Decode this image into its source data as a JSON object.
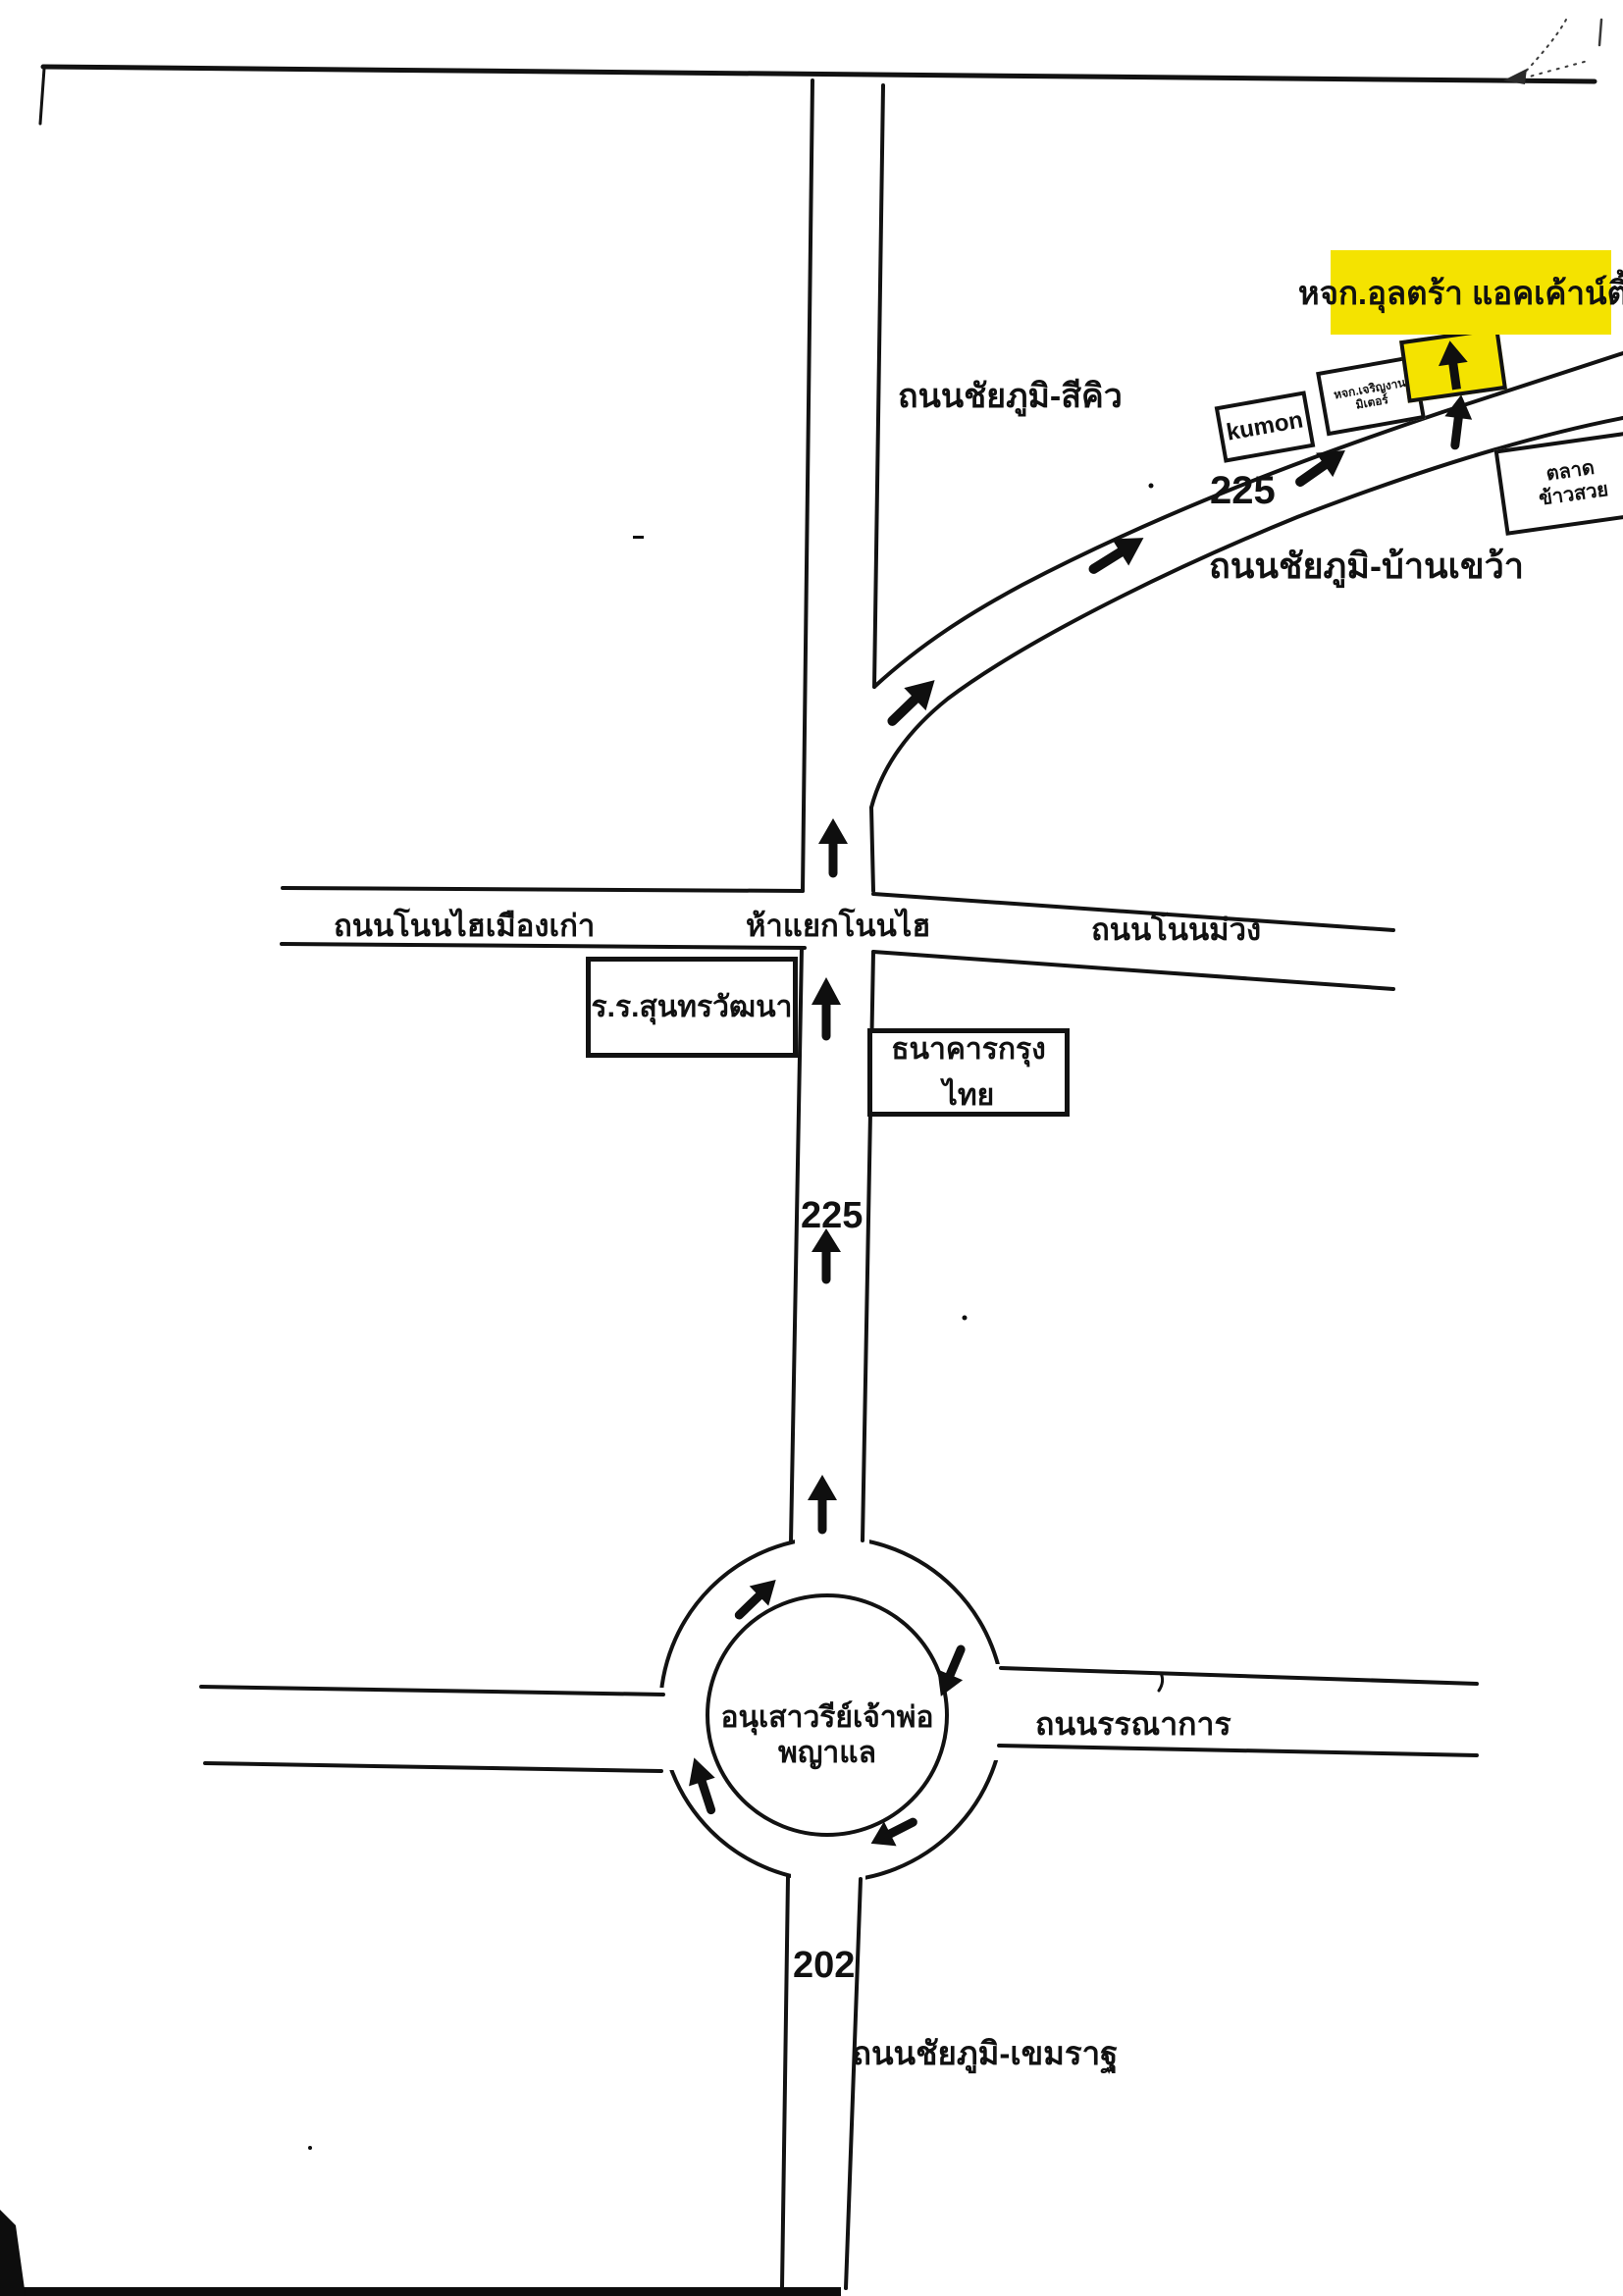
{
  "page": {
    "ink_color": "#111111",
    "highlight_color": "#f4e300",
    "background": "#ffffff"
  },
  "labels": {
    "company_highlight": "หจก.อุลตร้า แอคเค้าน์ติ้ง",
    "road_chaiyaphum_sikhio": "ถนนชัยภูมิ-สีคิว",
    "road_chaiyaphum_bankhwao": "ถนนชัยภูมิ-บ้านเขว้า",
    "road_nonhai_muangkao": "ถนนโนนไฮเมืองเก่า",
    "junction_hayaek_nonhai": "ห้าแยกโนนไฮ",
    "road_nonmuang": "ถนนโนนม่วง",
    "road_bannakan": "ถนนรรณาการ",
    "road_chaiyaphum_khemarat": "ถนนชัยภูมิ-เขมราฐ",
    "route_225_curve": "225",
    "route_225_mid": "225",
    "route_202": "202",
    "monument_line1": "อนุเสาวรีย์เจ้าพ่อ",
    "monument_line2": "พญาแล"
  },
  "buildings": {
    "kumon": "kumon",
    "charoen_line1": "หจก.เจริญงาน",
    "charoen_line2": "มิเตอร์",
    "market_line1": "ตลาด",
    "market_line2": "ข้าวสวย",
    "school": "ร.ร.สุนทรวัฒนา",
    "bank": "ธนาคารกรุงไทย"
  },
  "icons": {
    "direction_arrow": "up-arrow"
  }
}
